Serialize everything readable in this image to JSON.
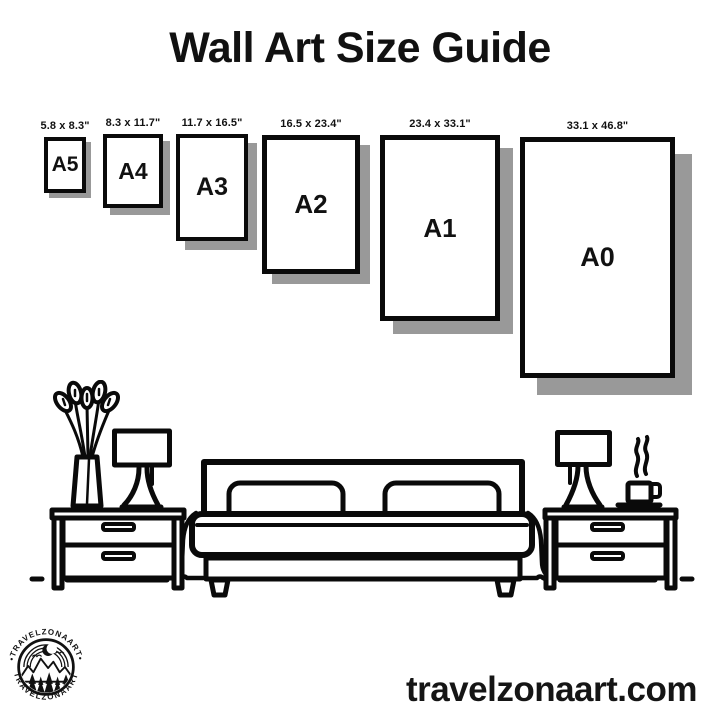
{
  "title": "Wall Art Size Guide",
  "sizes": [
    {
      "name": "A5",
      "dims": "5.8 x 8.3\""
    },
    {
      "name": "A4",
      "dims": "8.3 x 11.7\""
    },
    {
      "name": "A3",
      "dims": "11.7 x 16.5\""
    },
    {
      "name": "A2",
      "dims": "16.5 x 23.4\""
    },
    {
      "name": "A1",
      "dims": "23.4 x 33.1\""
    },
    {
      "name": "A0",
      "dims": "33.1 x 46.8\""
    }
  ],
  "logo": {
    "brand_top": "•TRAVELZONAART•",
    "brand_bottom": "TRAVELZONAART"
  },
  "footer": {
    "website": "travelzonaart.com"
  },
  "colors": {
    "ink": "#0a0a0a",
    "shadow": "#999999",
    "background": "#ffffff"
  }
}
